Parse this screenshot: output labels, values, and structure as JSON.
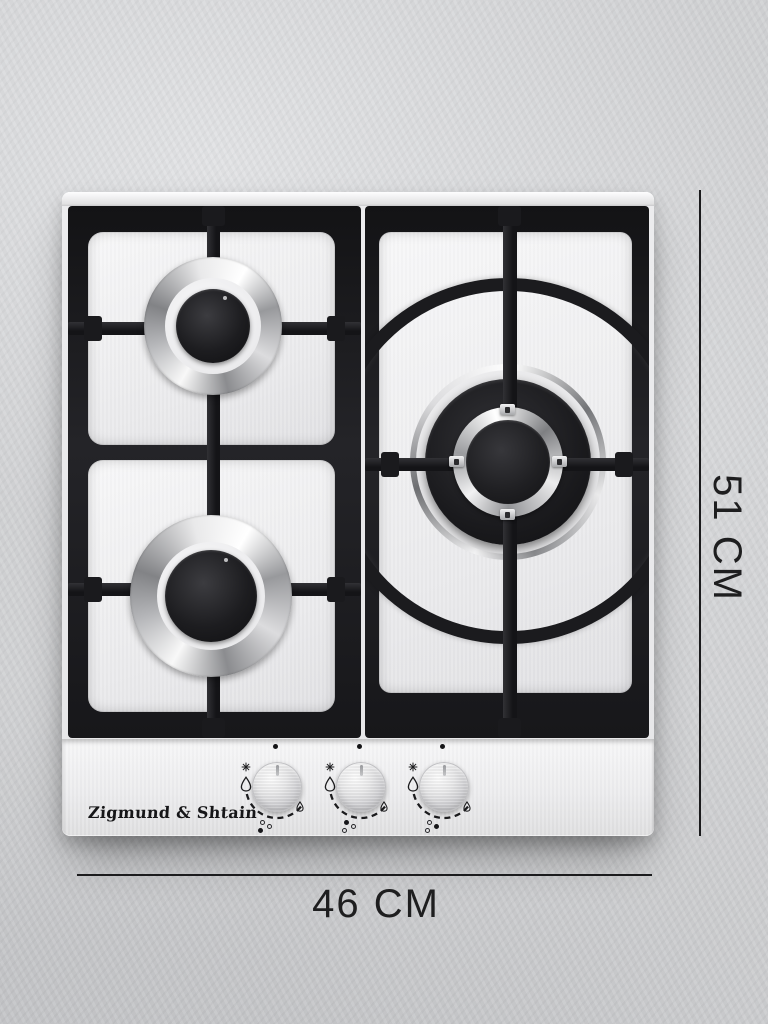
{
  "scene": {
    "description": "Product photo of a stainless-steel built-in gas hob on a gray concrete background with dimension annotations",
    "background_color": "#d2d3d5"
  },
  "product": {
    "brand": "Zigmund & Shtain",
    "type": "3-burner gas hob",
    "body_color": "#ededee",
    "grate_color": "#1b1b1d"
  },
  "dimensions": {
    "width": {
      "label": "46 CM",
      "value": 46,
      "unit": "CM"
    },
    "height": {
      "label": "51 CM",
      "value": 51,
      "unit": "CM"
    },
    "line_color": "#1b1b1d",
    "text_color": "#1e1e1f"
  },
  "burners": [
    {
      "name": "rear-left-burner",
      "size": "small"
    },
    {
      "name": "front-left-burner",
      "size": "medium"
    },
    {
      "name": "right-wok-burner",
      "size": "large"
    }
  ],
  "control_panel": {
    "brand_label": "Zigmund & Shtain",
    "icons": [
      "ignition-dot",
      "spark-icon",
      "flame-large-icon",
      "flame-small-icon",
      "knob-range-arc"
    ],
    "knobs": [
      {
        "name": "front-left-burner-knob",
        "pointer": "off",
        "indicator": {
          "rear_left": false,
          "front_left": true,
          "right": false
        }
      },
      {
        "name": "rear-left-burner-knob",
        "pointer": "off",
        "indicator": {
          "rear_left": true,
          "front_left": false,
          "right": false
        }
      },
      {
        "name": "right-burner-knob",
        "pointer": "off",
        "indicator": {
          "rear_left": false,
          "front_left": false,
          "right": true
        }
      }
    ]
  }
}
